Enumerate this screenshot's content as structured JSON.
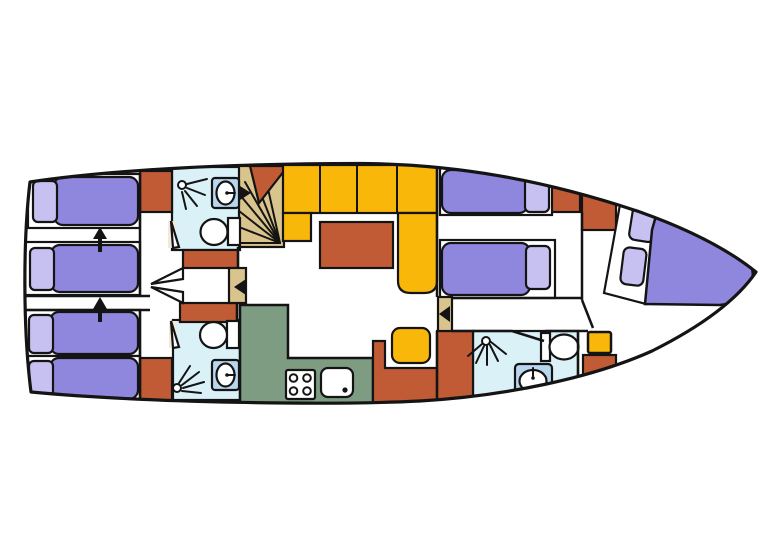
{
  "diagram": {
    "kind": "yacht-floor-plan",
    "orientation": "bow-right",
    "palette": {
      "background": "#ffffff",
      "floor": "#f3e9da",
      "outline": "#141414",
      "bed": "#8f87de",
      "pillow": "#c7c1f1",
      "cabinet": "#c15b36",
      "seating": "#f9b70a",
      "table": "#c15b36",
      "bathroom": "#dbf1f8",
      "galley": "#7e9c82",
      "stairs": "#d9c48d",
      "door": "#d9c48d",
      "fixture": "#ffffff",
      "sink": "#b9d6ef"
    },
    "areas": [
      {
        "id": "aft-cabin-upper",
        "label": "aft twin cabin"
      },
      {
        "id": "aft-cabin-lower",
        "label": "aft twin cabin"
      },
      {
        "id": "bathroom-aft-upper",
        "label": "bathroom"
      },
      {
        "id": "bathroom-aft-lower",
        "label": "bathroom"
      },
      {
        "id": "staircase",
        "label": "companionway stairs"
      },
      {
        "id": "salon",
        "label": "salon"
      },
      {
        "id": "galley",
        "label": "galley"
      },
      {
        "id": "mid-cabin",
        "label": "mid twin cabin"
      },
      {
        "id": "bathroom-bow",
        "label": "bathroom"
      },
      {
        "id": "bow-cabin",
        "label": "bow v-bed cabin"
      }
    ],
    "fixtures": {
      "single_beds": 6,
      "double_v_beds": 1,
      "pillows": 8,
      "toilets": 3,
      "washbasins": 3,
      "showers": 3,
      "stoves": 1,
      "galley_sinks": 1,
      "sofas": 1,
      "tables": 1,
      "stools": 2,
      "cabinets": 10,
      "doors": 2,
      "door_swings": 4,
      "direction_arrows": 2
    }
  }
}
